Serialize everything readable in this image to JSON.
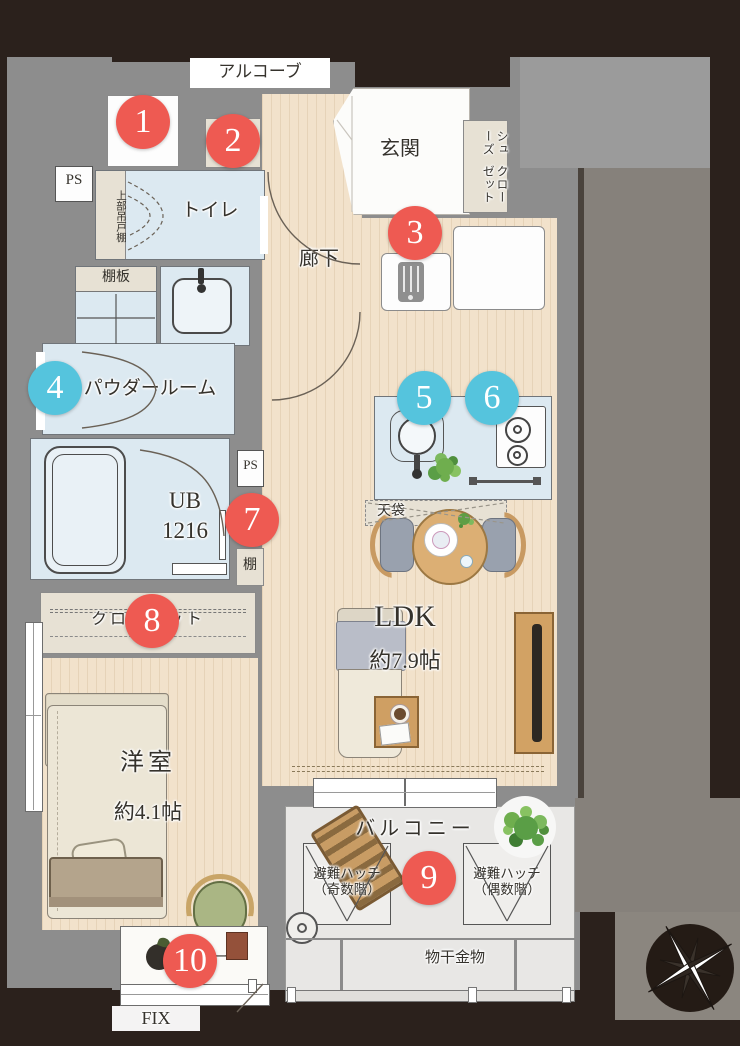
{
  "title": "マンション間取り図",
  "colors": {
    "background_dark": "#2b211c",
    "wall_gray": "#8d8d8d",
    "neighbor_gray": "#86817b",
    "room_blue": "#dce9f1",
    "wood_floor": "#f2e2cb",
    "storage_beige": "#e7e1d4",
    "balcony_gray": "#e8e7e5",
    "marker_red": "#ee5a52",
    "marker_blue": "#55c4dd"
  },
  "labels": {
    "alcove": "アルコーブ",
    "entrance": "玄関",
    "shoe_closet_line1": "シューズ",
    "shoe_closet_line2": "クローゼット",
    "ps_upper": "PS",
    "upper_hanging_cabinet": "上部吊戸棚",
    "toilet": "トイレ",
    "hallway": "廊下",
    "shelf_board": "棚板",
    "powder_room": "パウダールーム",
    "unit_bath": "UB",
    "unit_bath_size": "1216",
    "ps_middle": "PS",
    "shelf": "棚",
    "closet": "クローゼット",
    "ceiling_storage": "天袋",
    "ldk": "LDK",
    "ldk_size": "約7.9帖",
    "western_room": "洋室",
    "western_room_size": "約4.1帖",
    "balcony": "バルコニー",
    "hatch_odd_line1": "避難ハッチ",
    "hatch_odd_line2": "（奇数階）",
    "hatch_even_line1": "避難ハッチ",
    "hatch_even_line2": "（偶数階）",
    "laundry_fitting": "物干金物",
    "fix_window": "FIX",
    "counter": "カウンター"
  },
  "markers": [
    {
      "number": "1",
      "color": "red"
    },
    {
      "number": "2",
      "color": "red"
    },
    {
      "number": "3",
      "color": "red"
    },
    {
      "number": "4",
      "color": "blue"
    },
    {
      "number": "5",
      "color": "blue"
    },
    {
      "number": "6",
      "color": "blue"
    },
    {
      "number": "7",
      "color": "red"
    },
    {
      "number": "8",
      "color": "red"
    },
    {
      "number": "9",
      "color": "red"
    },
    {
      "number": "10",
      "color": "red"
    }
  ]
}
